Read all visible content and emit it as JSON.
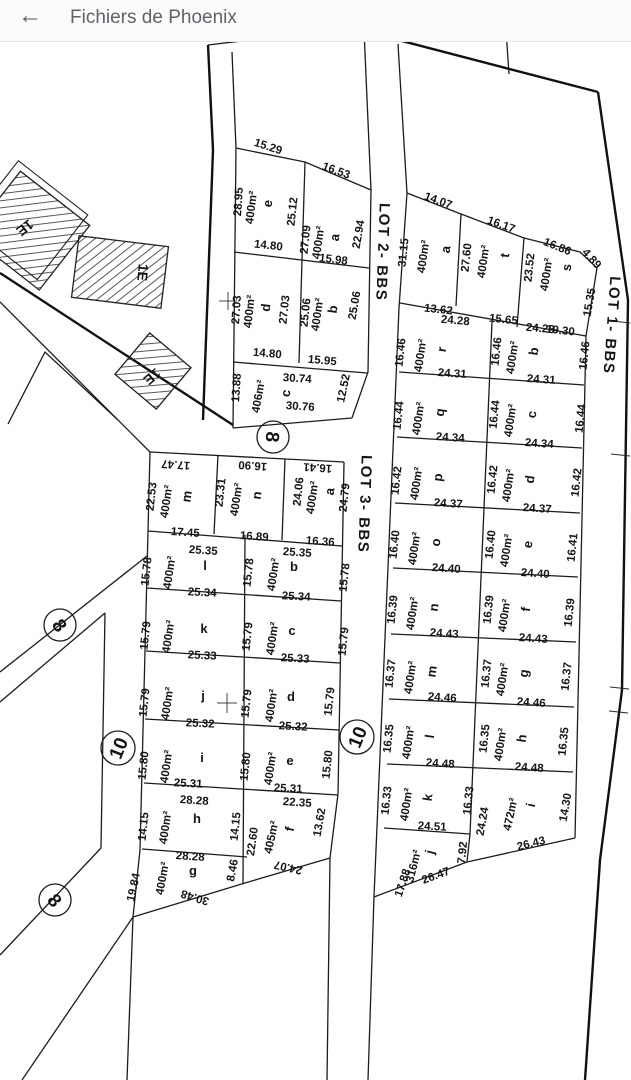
{
  "header": {
    "back_icon": "←",
    "title": "Fichiers de Phoenix"
  },
  "plan": {
    "building_label": "1E",
    "street_markers": {
      "n8": "8",
      "n10": "10"
    },
    "lot2": {
      "label": "LOT 2- BBS",
      "e": {
        "name": "e",
        "area": "400m²",
        "top": "15.29",
        "left": "28.95",
        "right": "25.12",
        "bottom": "14.80"
      },
      "a": {
        "name": "a",
        "area": "400m²",
        "top": "16.53",
        "left": "27.09",
        "right": "22.94",
        "bottom": "15.98"
      },
      "d": {
        "name": "d",
        "area": "400m²",
        "left": "27.03",
        "right": "27.03",
        "bottom": "14.80"
      },
      "b": {
        "name": "b",
        "area": "400m²",
        "left": "25.06",
        "right": "25.06",
        "bottom": "15.95"
      },
      "c": {
        "name": "c",
        "area": "406m²",
        "top": "30.74",
        "bottom": "30.76",
        "left": "13.88",
        "right": "12.52"
      }
    },
    "lot3": {
      "label": "LOT 3- BBS",
      "top_row": [
        {
          "name": "m",
          "area": "400m²",
          "top": "17.47",
          "left": "22.53",
          "right": "23.31",
          "bottom": "17.45"
        },
        {
          "name": "n",
          "area": "400m²",
          "top": "16.90",
          "right": "24.06",
          "bottom": "16.89"
        },
        {
          "name": "a",
          "area": "400m²",
          "top": "16.41",
          "right": "24.79",
          "bottom": "16.36"
        }
      ],
      "rows": [
        {
          "l": {
            "name": "l",
            "area": "400m²",
            "top": "25.35",
            "bottom": "25.34"
          },
          "r": {
            "name": "b",
            "area": "400m²",
            "top": "25.35",
            "bottom": "25.34"
          },
          "s1": "15.78",
          "s2": "15.78",
          "s3": "15.78"
        },
        {
          "l": {
            "name": "k",
            "area": "400m²",
            "bottom": "25.33"
          },
          "r": {
            "name": "c",
            "area": "400m²",
            "bottom": "25.33"
          },
          "s1": "15.79",
          "s2": "15.79",
          "s3": "15.79"
        },
        {
          "l": {
            "name": "j",
            "area": "400m²",
            "bottom": "25.32"
          },
          "r": {
            "name": "d",
            "area": "400m²",
            "bottom": "25.32"
          },
          "s1": "15.79",
          "s2": "15.79",
          "s3": "15.79"
        },
        {
          "l": {
            "name": "i",
            "area": "400m²",
            "bottom": "25.31"
          },
          "r": {
            "name": "e",
            "area": "400m²",
            "bottom": "25.31"
          },
          "s1": "15.80",
          "s2": "15.80",
          "s3": "15.80"
        }
      ],
      "h": {
        "name": "h",
        "area": "400m²",
        "top": "28.28",
        "left": "14.15",
        "right": "14.15"
      },
      "f": {
        "name": "f",
        "area": "405m²",
        "top": "22.35",
        "left": "22.60",
        "right": "13.62",
        "bottom": "24.07"
      },
      "g": {
        "name": "g",
        "area": "400m²",
        "top": "28.28",
        "left": "19.84",
        "right": "8.46",
        "bottom": "30.48"
      }
    },
    "lot1": {
      "label": "LOT 1- BBS",
      "top_row": [
        {
          "name": "a",
          "area": "400m²",
          "top": "14.07",
          "left": "31.15",
          "bottom": "13.62"
        },
        {
          "name": "t",
          "area": "400m²",
          "top": "16.17",
          "left": "27.60",
          "bottom": "15.65"
        },
        {
          "name": "s",
          "area": "400m²",
          "top": "16.86",
          "corner": "4.89",
          "left": "23.52",
          "right": "15.35",
          "bottom": "19.30"
        }
      ],
      "rows": [
        {
          "l": {
            "name": "r",
            "area": "400m²",
            "top": "24.28",
            "bottom": "24.31"
          },
          "r": {
            "name": "b",
            "area": "400m²",
            "top": "24.28",
            "bottom": "24.31"
          },
          "s1": "16.46",
          "s2": "16.46",
          "s3": "16.46"
        },
        {
          "l": {
            "name": "q",
            "area": "400m²",
            "bottom": "24.34"
          },
          "r": {
            "name": "c",
            "area": "400m²",
            "bottom": "24.34"
          },
          "s1": "16.44",
          "s2": "16.44",
          "s3": "16.44"
        },
        {
          "l": {
            "name": "p",
            "area": "400m²",
            "bottom": "24.37"
          },
          "r": {
            "name": "d",
            "area": "400m²",
            "bottom": "24.37"
          },
          "s1": "16.42",
          "s2": "16.42",
          "s3": "16.42"
        },
        {
          "l": {
            "name": "o",
            "area": "400m²",
            "bottom": "24.40"
          },
          "r": {
            "name": "e",
            "area": "400m²",
            "bottom": "24.40"
          },
          "s1": "16.40",
          "s2": "16.40",
          "s3": "16.41"
        },
        {
          "l": {
            "name": "n",
            "area": "400m²",
            "bottom": "24.43"
          },
          "r": {
            "name": "f",
            "area": "400m²",
            "bottom": "24.43"
          },
          "s1": "16.39",
          "s2": "16.39",
          "s3": "16.39"
        },
        {
          "l": {
            "name": "m",
            "area": "400m²",
            "bottom": "24.46"
          },
          "r": {
            "name": "g",
            "area": "400m²",
            "bottom": "24.46"
          },
          "s1": "16.37",
          "s2": "16.37",
          "s3": "16.37"
        },
        {
          "l": {
            "name": "l",
            "area": "400m²",
            "bottom": "24.48"
          },
          "r": {
            "name": "h",
            "area": "400m²",
            "bottom": "24.48"
          },
          "s1": "16.35",
          "s2": "16.35",
          "s3": "16.35"
        }
      ],
      "k": {
        "name": "k",
        "area": "400m²",
        "left": "16.33",
        "right": "16.33",
        "bottom": "24.51"
      },
      "i": {
        "name": "i",
        "area": "472m²",
        "left": "24.24",
        "right": "14.30",
        "bottom": "26.43"
      },
      "j": {
        "name": "j",
        "area": "316m²",
        "left": "17.88",
        "right": "7.92",
        "bottom": "26.47"
      }
    }
  }
}
